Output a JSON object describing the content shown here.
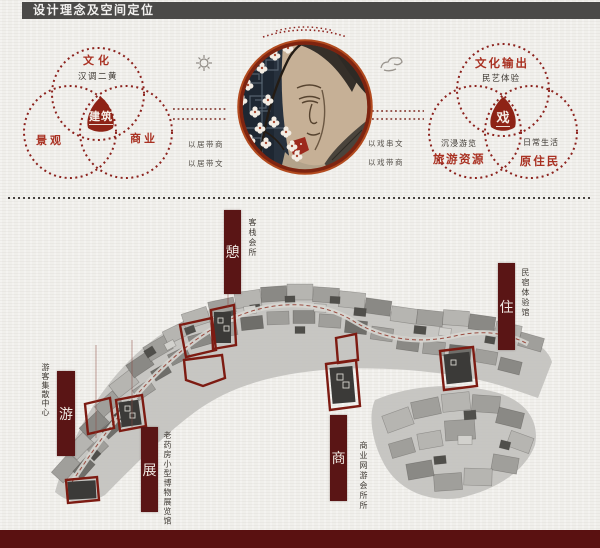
{
  "header": {
    "title": "设计理念及空间定位"
  },
  "concept": {
    "left_venn": {
      "top": "文化",
      "top_sub": "汉调二黄",
      "left": "景观",
      "right": "商业",
      "center": "建筑"
    },
    "left_links": [
      "以居带商",
      "以居带文"
    ],
    "right_links": [
      "以戏串文",
      "以戏带商"
    ],
    "right_venn": {
      "top": "文化输出",
      "top_sub": "民艺体验",
      "left_sub": "沉浸游览",
      "left": "旅游资源",
      "right_sub": "日常生活",
      "right": "原住民",
      "center": "戏"
    },
    "decor_icons": [
      "sun-icon",
      "cloud-icon"
    ]
  },
  "site_map": {
    "markers": [
      {
        "char": "憩",
        "label": "客栈会所"
      },
      {
        "char": "住",
        "label": "民宿体验馆"
      },
      {
        "char": "游",
        "label": "游客集散中心"
      },
      {
        "char": "展",
        "label": "老药房小型博物展览馆"
      },
      {
        "char": "商",
        "label": "商业网游会所所"
      }
    ]
  },
  "colors": {
    "header_gray": "#4b4a48",
    "accent_red": "#8c221d",
    "banner_maroon": "#5a1515",
    "footer_maroon": "#5a1111",
    "triangle_red": "#8e2316"
  }
}
